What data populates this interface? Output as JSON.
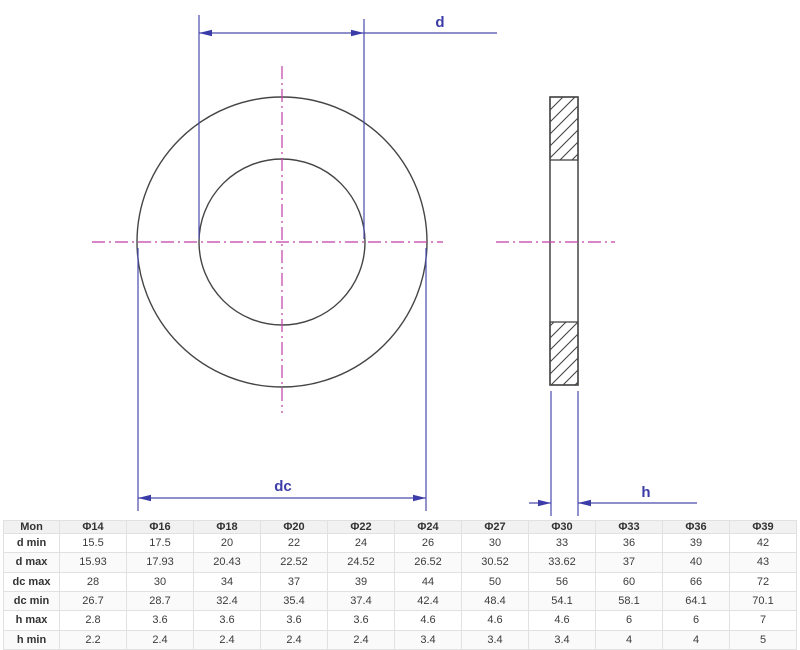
{
  "drawing": {
    "title": "flat-washer-technical-drawing",
    "labels": {
      "d": "d",
      "dc": "dc",
      "h": "h"
    },
    "colors": {
      "dimension": "#4a4aac",
      "dimension_text": "#3c3ca8",
      "centerline": "#c23fa7",
      "outline": "#454545"
    }
  },
  "table": {
    "header": [
      "Mon",
      "Φ14",
      "Φ16",
      "Φ18",
      "Φ20",
      "Φ22",
      "Φ24",
      "Φ27",
      "Φ30",
      "Φ33",
      "Φ36",
      "Φ39"
    ],
    "rows": [
      {
        "label": "d min",
        "values": [
          "15.5",
          "17.5",
          "20",
          "22",
          "24",
          "26",
          "30",
          "33",
          "36",
          "39",
          "42"
        ]
      },
      {
        "label": "d max",
        "values": [
          "15.93",
          "17.93",
          "20.43",
          "22.52",
          "24.52",
          "26.52",
          "30.52",
          "33.62",
          "37",
          "40",
          "43"
        ]
      },
      {
        "label": "dc max",
        "values": [
          "28",
          "30",
          "34",
          "37",
          "39",
          "44",
          "50",
          "56",
          "60",
          "66",
          "72"
        ]
      },
      {
        "label": "dc min",
        "values": [
          "26.7",
          "28.7",
          "32.4",
          "35.4",
          "37.4",
          "42.4",
          "48.4",
          "54.1",
          "58.1",
          "64.1",
          "70.1"
        ]
      },
      {
        "label": "h max",
        "values": [
          "2.8",
          "3.6",
          "3.6",
          "3.6",
          "3.6",
          "4.6",
          "4.6",
          "4.6",
          "6",
          "6",
          "7"
        ]
      },
      {
        "label": "h min",
        "values": [
          "2.2",
          "2.4",
          "2.4",
          "2.4",
          "2.4",
          "3.4",
          "3.4",
          "3.4",
          "4",
          "4",
          "5"
        ]
      }
    ]
  }
}
